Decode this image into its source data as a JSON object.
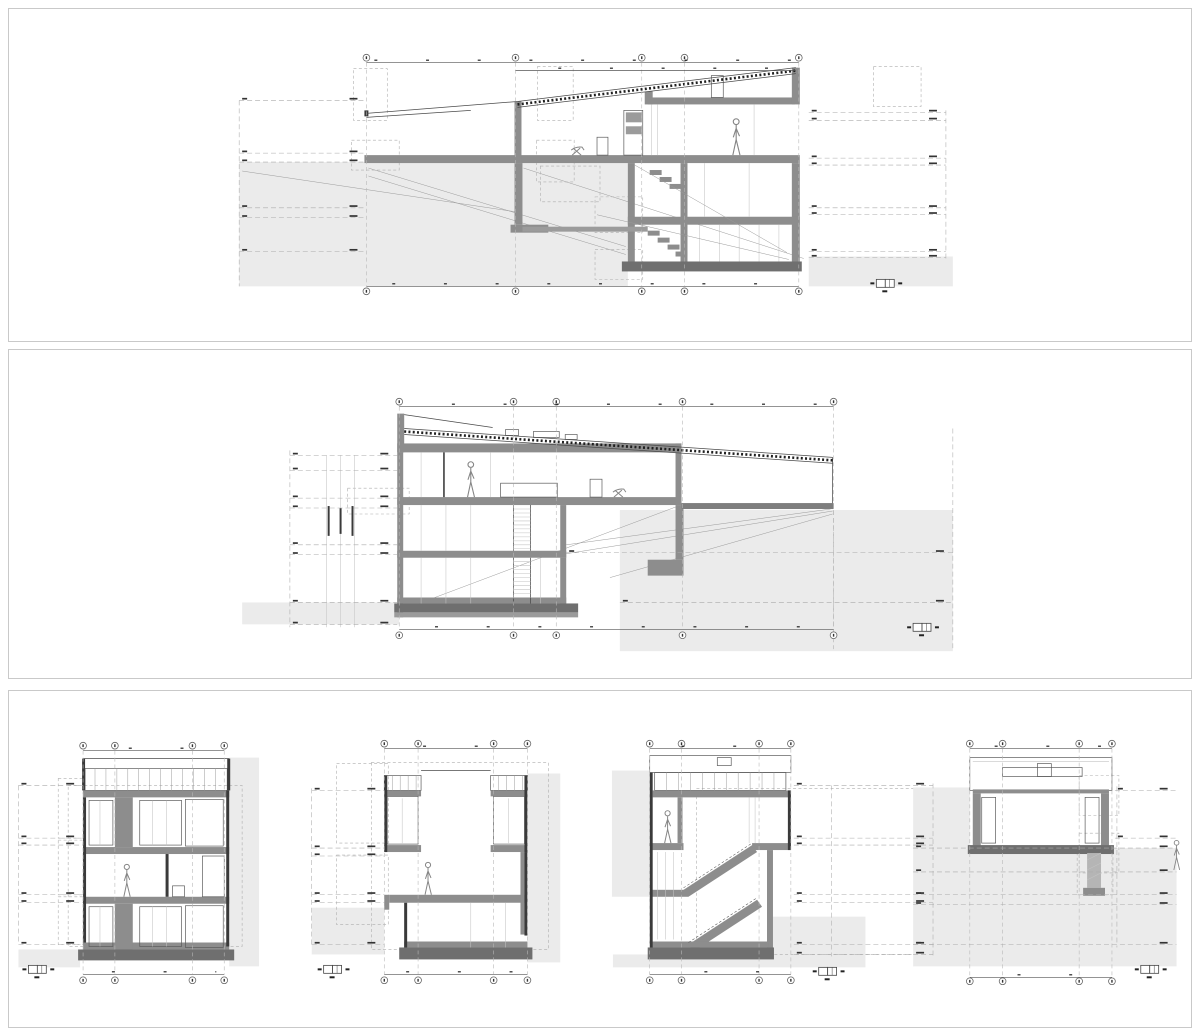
{
  "sheet": {
    "name": "architectural-sections-sheet",
    "width": 1200,
    "height": 1036,
    "background": "#ffffff",
    "panel_border": "#c9c9c9"
  },
  "colors": {
    "ground_fill": "#ebebeb",
    "wall_poche": "#8d8d8d",
    "foundation": "#6f6f6f",
    "section_line": "#4a4a4a",
    "datum_dashed": "#ababab",
    "grid_dashed": "#b8b8b8",
    "annotation_text": "#161616"
  },
  "panels": [
    {
      "id": "panel-1",
      "name": "longitudinal-section-1",
      "frame": [
        8,
        8,
        1184,
        334
      ]
    },
    {
      "id": "panel-2",
      "name": "longitudinal-section-2",
      "frame": [
        8,
        349,
        1184,
        330
      ]
    },
    {
      "id": "panel-3",
      "name": "cross-sections-row",
      "frame": [
        8,
        690,
        1184,
        338
      ]
    }
  ],
  "sections": [
    {
      "id": "long-section-a",
      "panel": 1,
      "grid": {
        "xs": [
          365,
          515,
          642,
          685,
          800
        ],
        "top_y": 57,
        "bottom_y": 292,
        "line_y1": 62,
        "line_y2": 287
      },
      "dims": [
        [
          365,
          800,
          62
        ],
        [
          515,
          797,
          70
        ],
        [
          365,
          800,
          287
        ]
      ],
      "levels": [
        [
          237,
          365,
          100
        ],
        [
          237,
          365,
          153
        ],
        [
          237,
          365,
          162
        ],
        [
          237,
          365,
          208
        ],
        [
          237,
          365,
          218
        ],
        [
          237,
          365,
          252
        ],
        [
          810,
          948,
          112
        ],
        [
          810,
          948,
          120
        ],
        [
          810,
          948,
          158
        ],
        [
          810,
          948,
          165
        ],
        [
          810,
          948,
          208
        ],
        [
          810,
          948,
          215
        ],
        [
          810,
          948,
          252
        ],
        [
          810,
          948,
          258
        ]
      ],
      "vguides": [
        [
          237,
          100,
          287
        ],
        [
          948,
          110,
          260
        ]
      ],
      "persons": [
        [
          737,
          155,
          37
        ]
      ],
      "chairs": [
        [
          578,
          155
        ]
      ],
      "scalebars": [
        [
          878,
          280
        ]
      ]
    },
    {
      "id": "long-section-b",
      "panel": 2,
      "grid": {
        "xs": [
          398,
          513,
          556,
          683,
          835
        ],
        "top_y": 401,
        "bottom_y": 636,
        "line_y1": 406,
        "line_y2": 630
      },
      "dims": [
        [
          398,
          835,
          406
        ],
        [
          398,
          835,
          630
        ]
      ],
      "levels": [
        [
          288,
          396,
          455
        ],
        [
          288,
          396,
          470
        ],
        [
          288,
          396,
          498
        ],
        [
          288,
          396,
          508
        ],
        [
          288,
          396,
          545
        ],
        [
          288,
          396,
          555
        ],
        [
          288,
          396,
          603
        ],
        [
          288,
          396,
          625
        ],
        [
          566,
          955,
          553
        ],
        [
          620,
          955,
          603
        ]
      ],
      "vguides": [
        [
          288,
          450,
          628
        ],
        [
          835,
          510,
          650
        ],
        [
          955,
          428,
          650
        ]
      ],
      "persons": [
        [
          470,
          497,
          36
        ]
      ],
      "chairs": [
        [
          620,
          497
        ]
      ],
      "scalebars": [
        [
          915,
          624
        ]
      ]
    },
    {
      "id": "cross-section-c",
      "panel": 3,
      "grid": {
        "xs": [
          80,
          112,
          190,
          222
        ],
        "top_y": 745,
        "bottom_y": 981,
        "line_y1": 750,
        "line_y2": 975
      },
      "dims": [
        [
          80,
          222,
          750
        ],
        [
          80,
          222,
          975
        ]
      ],
      "levels": [
        [
          15,
          80,
          785
        ],
        [
          15,
          80,
          838
        ],
        [
          15,
          80,
          845
        ],
        [
          15,
          80,
          895
        ],
        [
          15,
          80,
          903
        ],
        [
          15,
          80,
          945
        ]
      ],
      "vguides": [
        [
          15,
          785,
          945
        ]
      ],
      "persons": [
        [
          124,
          897,
          33
        ]
      ],
      "chairs": [],
      "scalebars": [
        [
          25,
          966
        ]
      ]
    },
    {
      "id": "cross-section-d",
      "panel": 3,
      "grid": {
        "xs": [
          383,
          417,
          493,
          527
        ],
        "top_y": 743,
        "bottom_y": 981,
        "line_y1": 748,
        "line_y2": 975
      },
      "dims": [
        [
          383,
          527,
          748
        ],
        [
          383,
          527,
          975
        ]
      ],
      "levels": [
        [
          310,
          383,
          790
        ],
        [
          310,
          383,
          848
        ],
        [
          310,
          383,
          856
        ],
        [
          310,
          383,
          895
        ],
        [
          310,
          383,
          903
        ],
        [
          310,
          383,
          945
        ]
      ],
      "vguides": [
        [
          310,
          788,
          948
        ]
      ],
      "persons": [
        [
          427,
          895,
          33
        ]
      ],
      "chairs": [],
      "scalebars": [
        [
          322,
          966
        ]
      ]
    },
    {
      "id": "cross-section-e",
      "panel": 3,
      "grid": {
        "xs": [
          650,
          682,
          760,
          792
        ],
        "top_y": 743,
        "bottom_y": 981,
        "line_y1": 748,
        "line_y2": 975
      },
      "dims": [
        [
          650,
          792,
          748
        ],
        [
          650,
          792,
          975
        ]
      ],
      "levels": [
        [
          795,
          935,
          785
        ],
        [
          795,
          935,
          838
        ],
        [
          795,
          935,
          845
        ],
        [
          795,
          935,
          895
        ],
        [
          795,
          935,
          903
        ],
        [
          795,
          935,
          945
        ],
        [
          795,
          935,
          955
        ]
      ],
      "vguides": [
        [
          833,
          785,
          957
        ],
        [
          935,
          783,
          957
        ]
      ],
      "persons": [
        [
          668,
          843,
          33
        ]
      ],
      "chairs": [],
      "scalebars": [
        [
          820,
          968
        ]
      ]
    },
    {
      "id": "cross-section-f",
      "panel": 3,
      "grid": {
        "xs": [
          972,
          1005,
          1082,
          1115
        ],
        "top_y": 743,
        "bottom_y": 982,
        "line_y1": 748,
        "line_y2": 978
      },
      "dims": [
        [
          972,
          1115,
          748
        ],
        [
          972,
          1115,
          978
        ]
      ],
      "levels": [
        [
          1118,
          1180,
          790
        ],
        [
          1118,
          1180,
          838
        ],
        [
          915,
          1180,
          848
        ],
        [
          915,
          1180,
          872
        ],
        [
          915,
          1180,
          895
        ],
        [
          915,
          1180,
          905
        ],
        [
          915,
          1180,
          945
        ]
      ],
      "vguides": [
        [
          1120,
          786,
          948
        ]
      ],
      "persons": [
        [
          1180,
          870,
          30
        ]
      ],
      "chairs": [],
      "scalebars": [
        [
          1144,
          966
        ]
      ]
    }
  ]
}
